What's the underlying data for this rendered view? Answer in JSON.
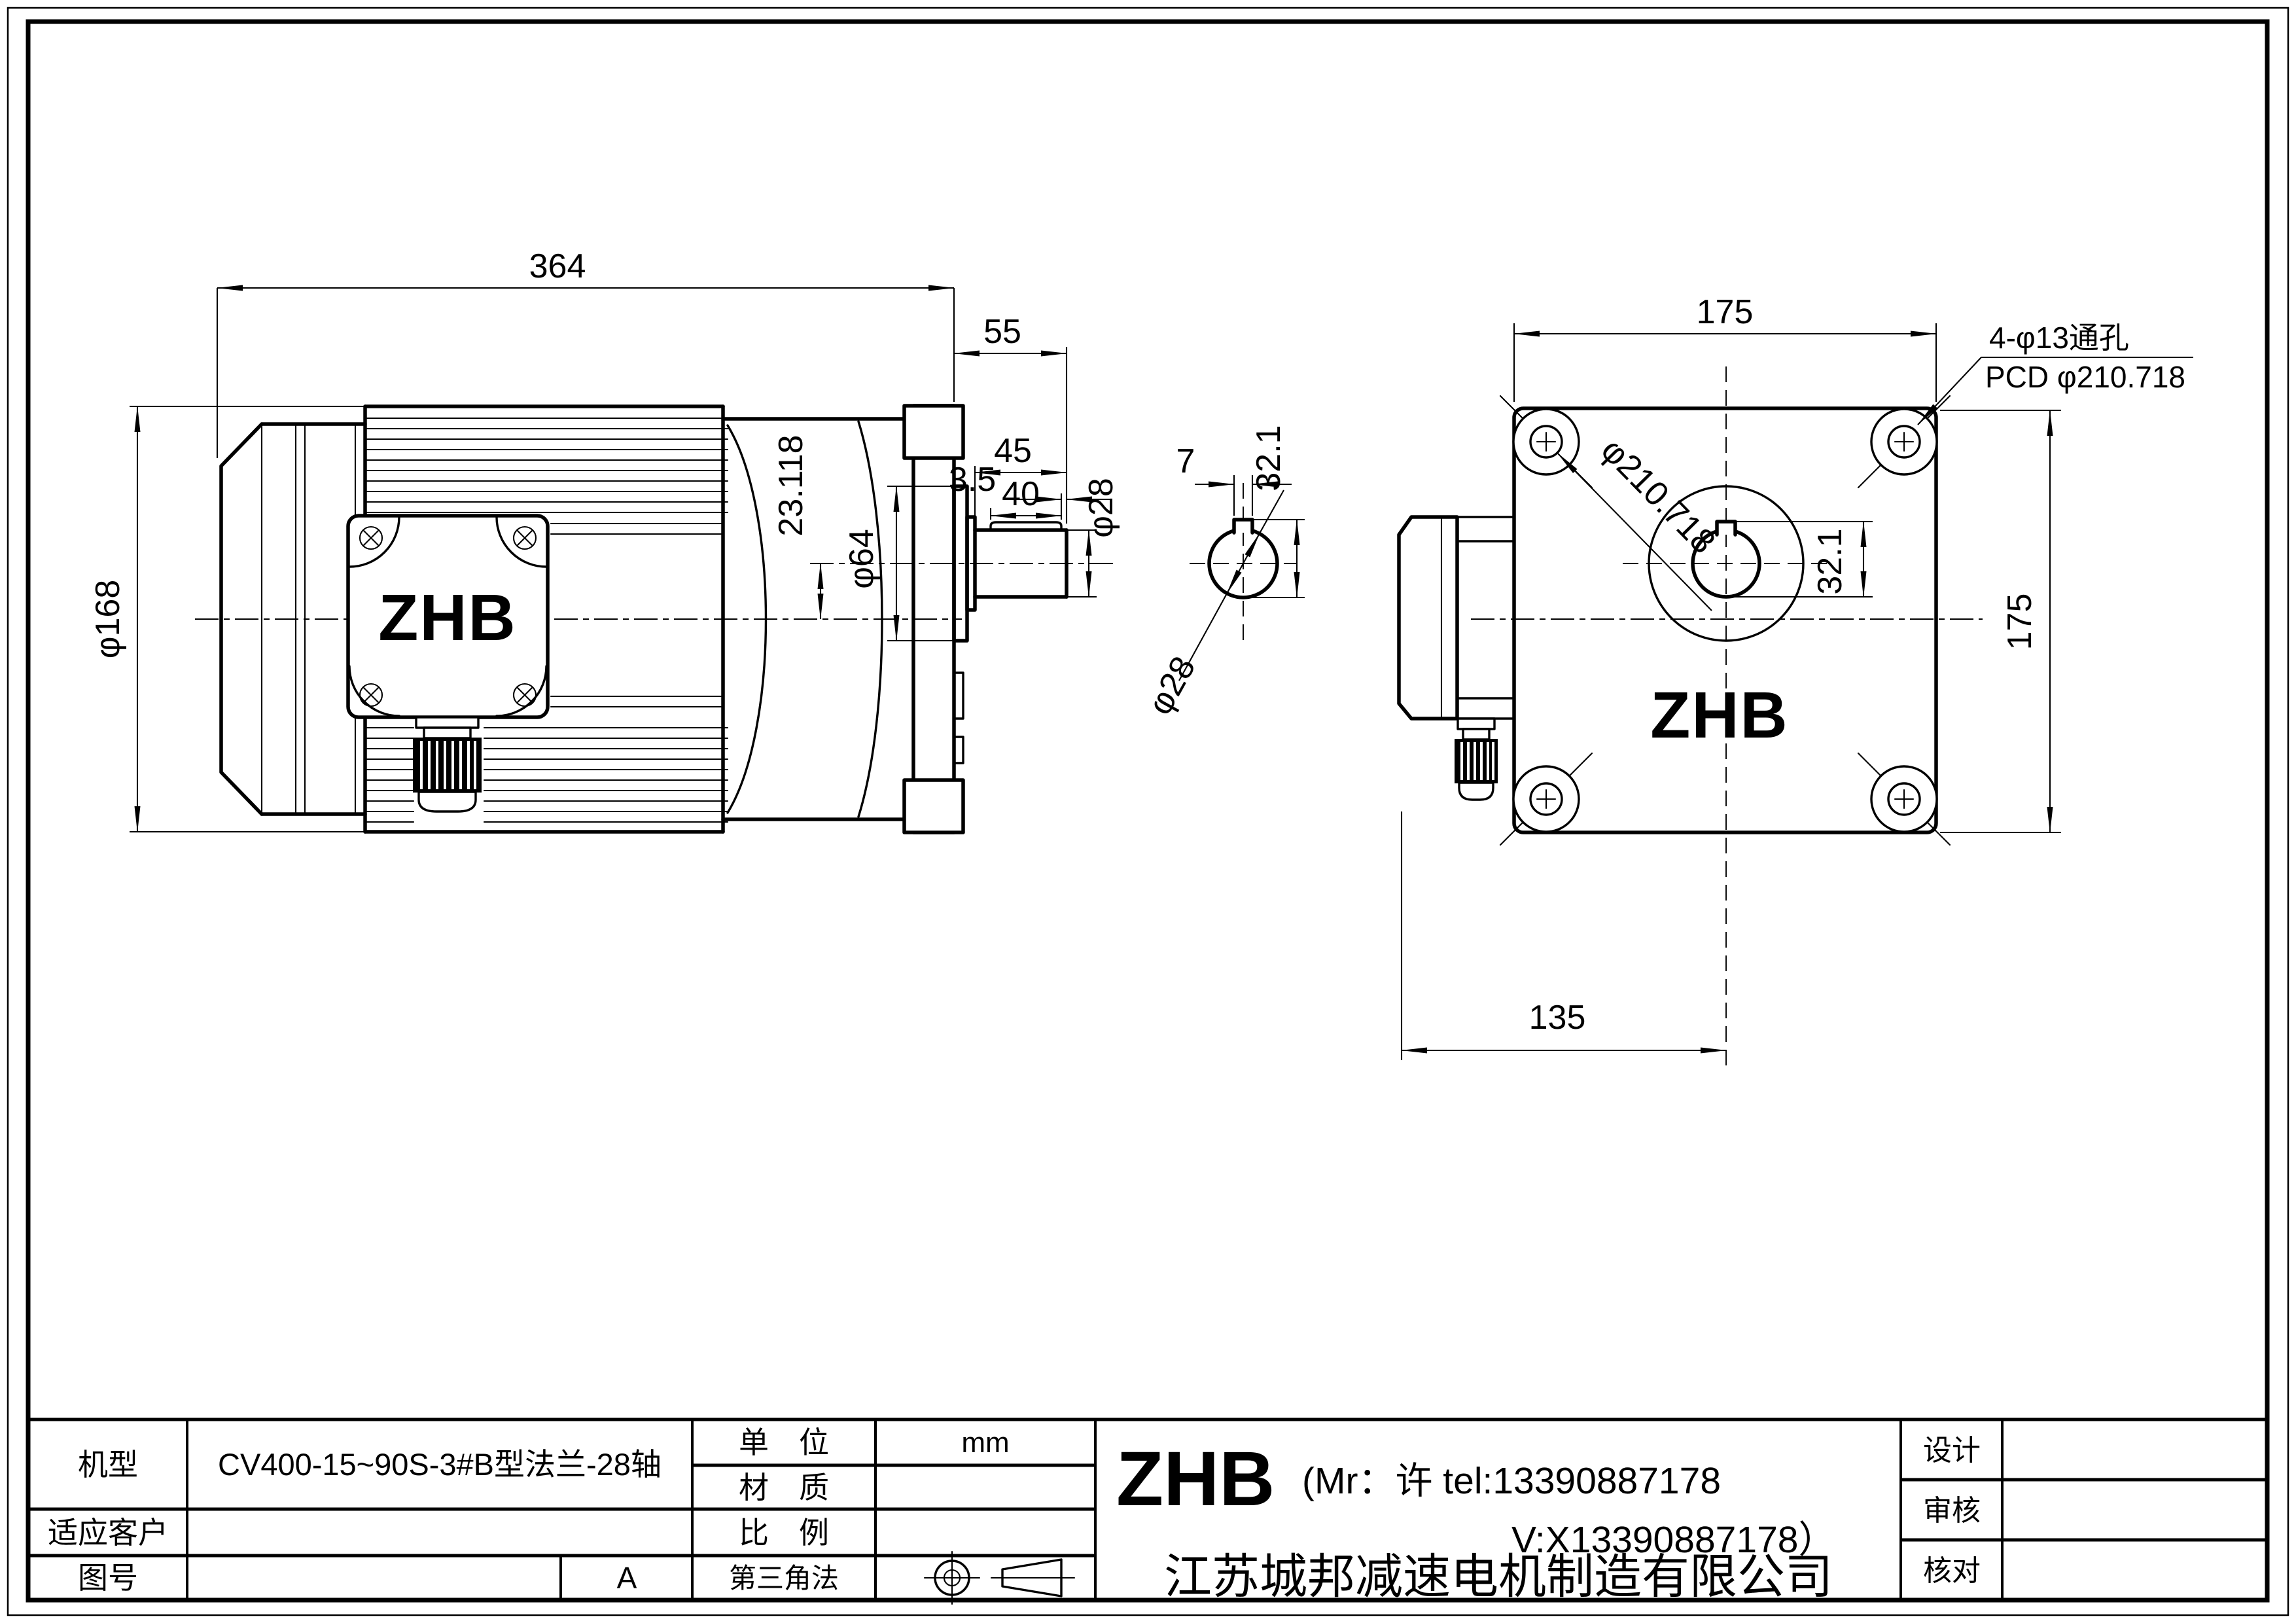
{
  "views": {
    "side": {
      "total_len": "364",
      "housing_len": "55",
      "shaft_len": "45",
      "key_len": "40",
      "key_end": "3.5",
      "shaft_dia": "φ28",
      "offset": "23.118",
      "pilot_dia": "φ64",
      "motor_dia": "φ168",
      "logo": "ZHB"
    },
    "section": {
      "key_w": "7",
      "height": "32.1",
      "dia": "φ28"
    },
    "front": {
      "width": "175",
      "height": "175",
      "box_off": "135",
      "pcd": "φ210.718",
      "hole_h": "32.1",
      "holes_note": "4-φ13通孔",
      "pcd_note": "PCD φ210.718",
      "logo": "ZHB"
    }
  },
  "title_block": {
    "model_label": "机型",
    "model": "CV400-15~90S-3#B型法兰-28轴",
    "customer_label": "适应客户",
    "customer": "",
    "dwg_label": "图号",
    "dwg": "",
    "rev": "A",
    "unit_label": "单　位",
    "unit": "mm",
    "material_label": "材　质",
    "material": "",
    "scale_label": "比　例",
    "scale": "",
    "projection_label": "第三角法",
    "brand": "ZHB",
    "contact1": "(Mr：许 tel:13390887178",
    "contact2": "V:X13390887178）",
    "company": "江苏城邦减速电机制造有限公司",
    "design_label": "设计",
    "design": "",
    "audit_label": "审核",
    "audit": "",
    "check_label": "核对",
    "check": ""
  }
}
